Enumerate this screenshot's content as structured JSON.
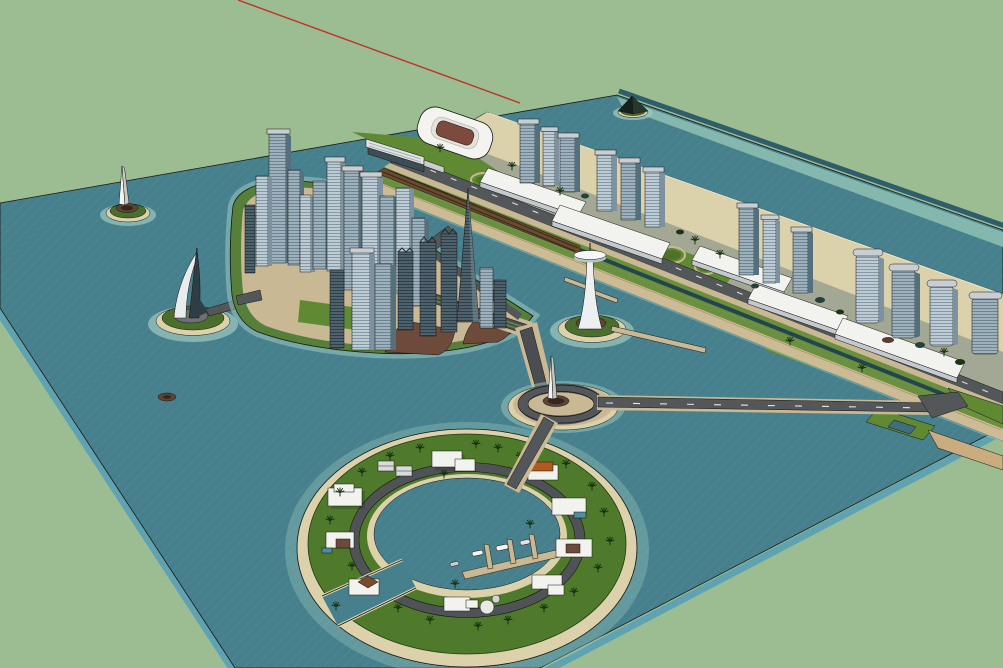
{
  "viewport": {
    "description": "3D modeling viewport showing a waterfront city master-plan model in axonometric perspective",
    "width_px": 1003,
    "height_px": 668,
    "background_color": "#9cbc92",
    "axis_guide_color": "#c03425"
  },
  "palette": {
    "bg": "#9cbc92",
    "axis_red": "#c03425",
    "water_deep": "#47808d",
    "water_shallow": "#84b7ad",
    "water_edge_light": "#5fa3b2",
    "water_edge_dark": "#2e5d6b",
    "halo": "#9ccac1",
    "sand": "#dbd2ab",
    "promenade": "#cdbb95",
    "tan_path": "#c9b894",
    "road": "#54575a",
    "road_olive": "#6a8f3f",
    "lawn_bright": "#5f8a33",
    "lawn_circle": "#4d7426",
    "island_green": "#4c6e2c",
    "rim_green": "#56803a",
    "ring_green": "#4f7a2c",
    "palm": "#16300f",
    "plaza_brown": "#6d4a3a",
    "rail_brown": "#6a4a30",
    "channel_teal": "#23454d",
    "white": "#f2f2ef",
    "podium_shade": "#c4c9cd",
    "cap": "#c9ced3",
    "pitch": "#7c4b3e",
    "station": "#3c4d55",
    "pyramid": "#1c2a21",
    "roof_orange": "#b05a20",
    "pool": "#4d8f9e",
    "disc_brown": "#5d4433",
    "disc_dark": "#36261c",
    "pad_gray": "#6e7174",
    "sail_dark": "#2f3d44",
    "outline": "#141414"
  },
  "scene": {
    "objects": [
      "sea-plane",
      "red-axis-guide-line",
      "coastal-strip",
      "beach",
      "stadium",
      "railway-station",
      "linear-water-channel",
      "beachfront-tower-cluster-1",
      "beachfront-tower-cluster-2",
      "beachfront-tower-cluster-3",
      "landscaped-park",
      "pyramid-islet",
      "downtown-skyscraper-island",
      "sail-hotel-tower-islet",
      "obelisk-islet",
      "observation-tower-islet",
      "central-roundabout",
      "roundabout-obelisk",
      "east-causeway",
      "south-bridge",
      "ring-residential-island",
      "ring-lagoon",
      "marina-dock",
      "villas",
      "palm-trees"
    ],
    "counts": {
      "downtown_skyscrapers": 21,
      "beachfront_towers": 13,
      "ring_villas": 10,
      "small_islets": 4
    }
  }
}
